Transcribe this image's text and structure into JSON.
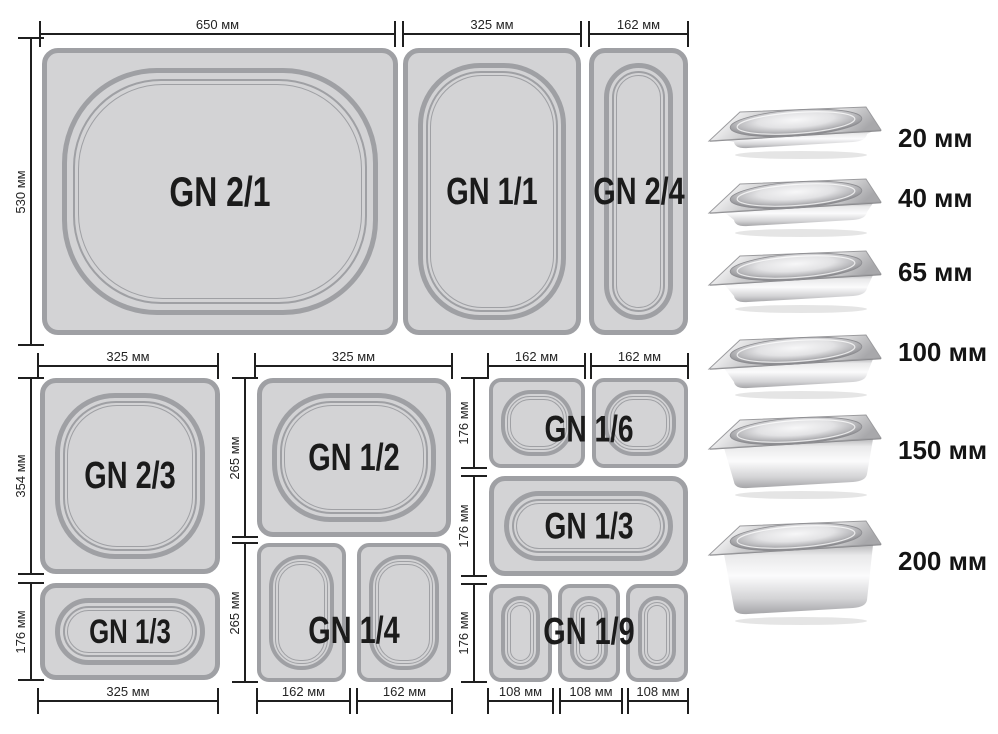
{
  "diagram": {
    "pans": [
      {
        "label": "GN 2/1"
      },
      {
        "label": "GN 1/1"
      },
      {
        "label": "GN 2/4"
      },
      {
        "label": "GN 2/3"
      },
      {
        "label": "GN 1/3"
      },
      {
        "label": "GN 1/2"
      },
      {
        "label": "GN 1/4"
      },
      {
        "label": "GN 1/6"
      },
      {
        "label": "GN 1/3"
      },
      {
        "label": "GN 1/9"
      }
    ],
    "dims": {
      "d650": "650 мм",
      "d530": "530 мм",
      "d325": "325 мм",
      "d162": "162 мм",
      "d354": "354 мм",
      "d176": "176 мм",
      "d265": "265 мм",
      "d108": "108 мм"
    }
  },
  "depths": {
    "items": [
      {
        "label": "20 мм"
      },
      {
        "label": "40 мм"
      },
      {
        "label": "65 мм"
      },
      {
        "label": "100 мм"
      },
      {
        "label": "150 мм"
      },
      {
        "label": "200 мм"
      }
    ]
  },
  "colors": {
    "pan_fill": "#d3d3d5",
    "pan_border": "#9fa0a4",
    "dim_line": "#1f1f1f",
    "label_text": "#1b1b1b"
  }
}
